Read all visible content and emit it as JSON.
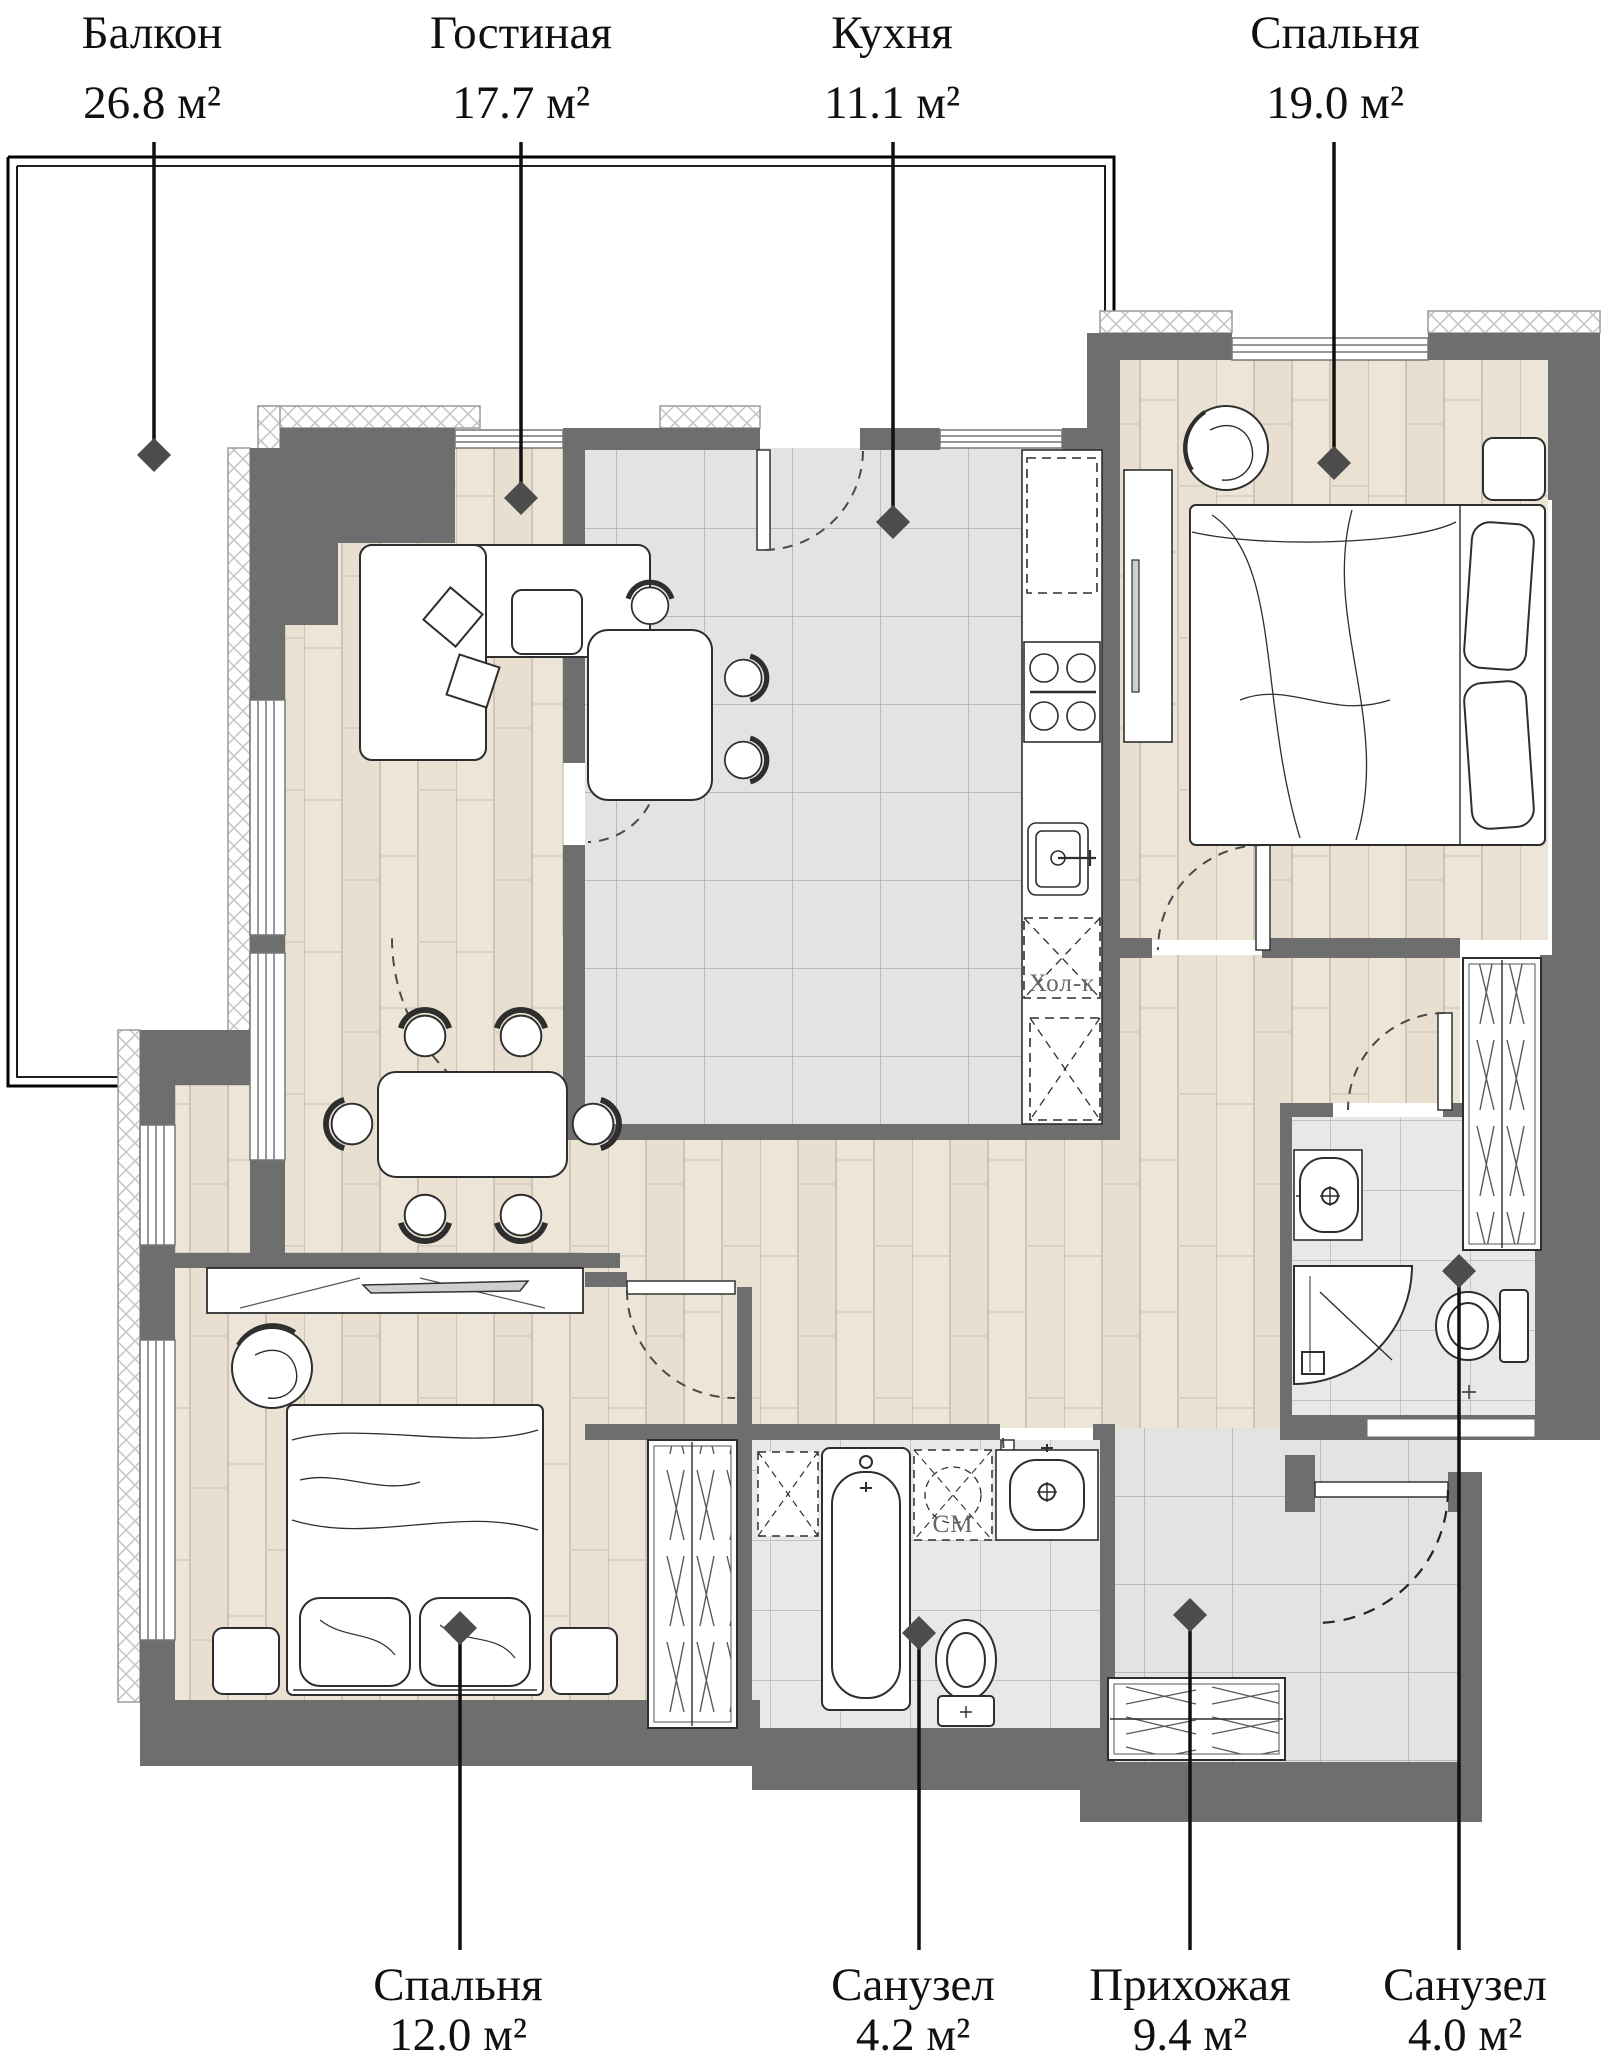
{
  "plan": {
    "type": "apartment-floor-plan",
    "units": "м²",
    "rooms": {
      "balcony": {
        "name": "Балкон",
        "area": "26.8 м²"
      },
      "living": {
        "name": "Гостиная",
        "area": "17.7 м²"
      },
      "kitchen": {
        "name": "Кухня",
        "area": "11.1 м²"
      },
      "bedroom_main": {
        "name": "Спальня",
        "area": "19.0 м²"
      },
      "bedroom_second": {
        "name": "Спальня",
        "area": "12.0 м²"
      },
      "bathroom_tub": {
        "name": "Санузел",
        "area": "4.2 м²"
      },
      "hallway": {
        "name": "Прихожая",
        "area": "9.4 м²"
      },
      "bathroom_shower": {
        "name": "Санузел",
        "area": "4.0 м²"
      }
    },
    "annotations": {
      "fridge": "Хол-к",
      "washer": "СМ"
    },
    "colors": {
      "wall": "#6e6e6e",
      "wood_floor": "#ede5d8",
      "tile_floor": "#e3e3e3",
      "bath_tile": "#e8e8e8",
      "leader": "#111111",
      "diamond": "#4c4c4c",
      "hatch": "#c7c7c7"
    }
  }
}
